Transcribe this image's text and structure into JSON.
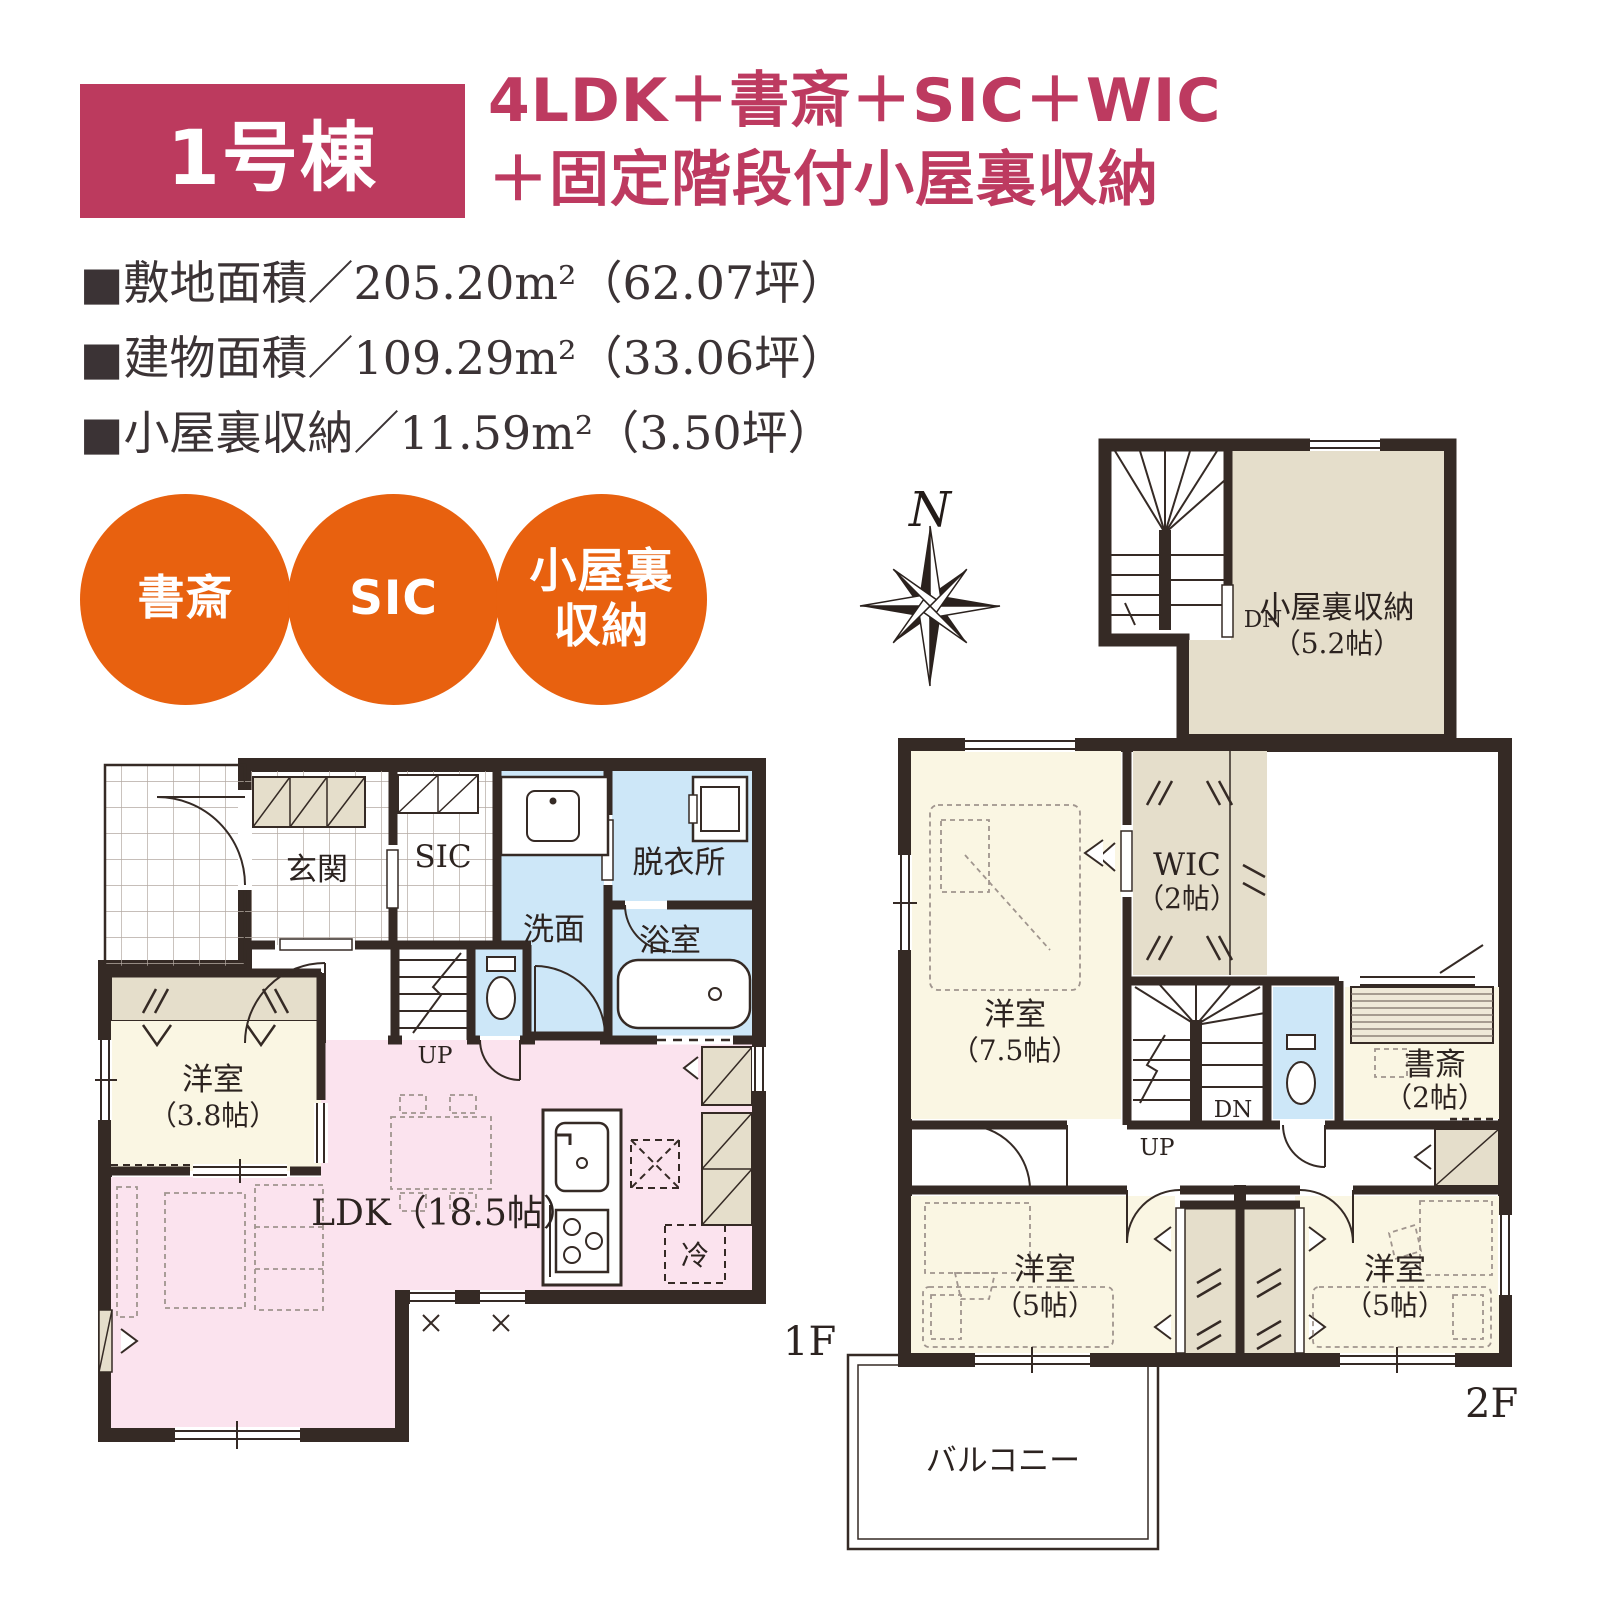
{
  "header": {
    "unit": "1号棟",
    "title_line1": "4LDK＋書斎＋SIC＋WIC",
    "title_line2": "＋固定階段付小屋裏収納"
  },
  "specs": [
    "■敷地面積／205.20m²（62.07坪）",
    "■建物面積／109.29m²（33.06坪）",
    "■小屋裏収納／11.59m²（3.50坪）"
  ],
  "badges": [
    [
      "書斎"
    ],
    [
      "SIC"
    ],
    [
      "小屋裏",
      "収納"
    ]
  ],
  "compass": {
    "north": "N"
  },
  "attic": {
    "name": "小屋裏収納",
    "size": "（5.2帖）",
    "dn": "DN"
  },
  "floor1": {
    "label": "1F",
    "genkan": "玄関",
    "sic": "SIC",
    "senmen": "洗面",
    "datsui": "脱衣所",
    "bath": "浴室",
    "west_room": "洋室",
    "west_room_size": "（3.8帖）",
    "ldk": "LDK（18.5帖）",
    "up": "UP",
    "fridge": "冷"
  },
  "floor2": {
    "label": "2F",
    "room1": "洋室",
    "room1_size": "（7.5帖）",
    "wic": "WIC",
    "wic_size": "（2帖）",
    "study": "書斎",
    "study_size": "（2帖）",
    "room2": "洋室",
    "room2_size": "（5帖）",
    "room3": "洋室",
    "room3_size": "（5帖）",
    "up": "UP",
    "dn": "DN",
    "balcony": "バルコニー"
  },
  "colors": {
    "accent_crimson": "#bc3a5e",
    "accent_orange": "#e8610f",
    "wall": "#352a25",
    "room_pink": "#fbe3ee",
    "room_cream": "#faf6e3",
    "room_blue": "#cde7f8",
    "room_beige": "#e5decb"
  }
}
